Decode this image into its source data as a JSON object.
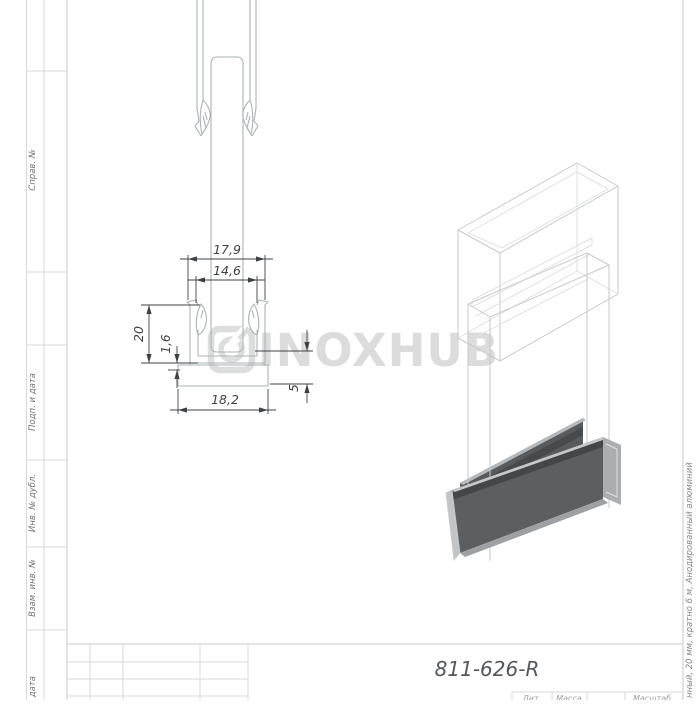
{
  "sidebar": {
    "labels": [
      "Справ. №",
      "Подп. и дата",
      "Инв. № дубл.",
      "Взам. инв. №",
      "Подп. и дата"
    ]
  },
  "title_block": {
    "part_number": "811-626-R",
    "corner_headers": [
      "Лит.",
      "Масса",
      "Масштаб"
    ]
  },
  "margin_note": "нный, 20 мм, кратно 6 м, Анодированный алюминий",
  "watermark": {
    "text": "INOXHUB",
    "logo": "inoxhub-logo",
    "color": "#dcdcdc"
  },
  "dimensions": {
    "outer_width": "17,9",
    "slot_width": "14,6",
    "height": "20",
    "wall_thickness": "1,6",
    "base_width": "18,2",
    "base_height": "5"
  },
  "colors": {
    "dimension_lines": "#3f4245",
    "profile_lines": "#aeb3b5",
    "frame_lines": "#d7d9db",
    "channel_dark": "#5c5f62",
    "gasket_dark": "#44474a",
    "metal_light": "#c5c8ca",
    "watermark": "#dcdcdc"
  }
}
